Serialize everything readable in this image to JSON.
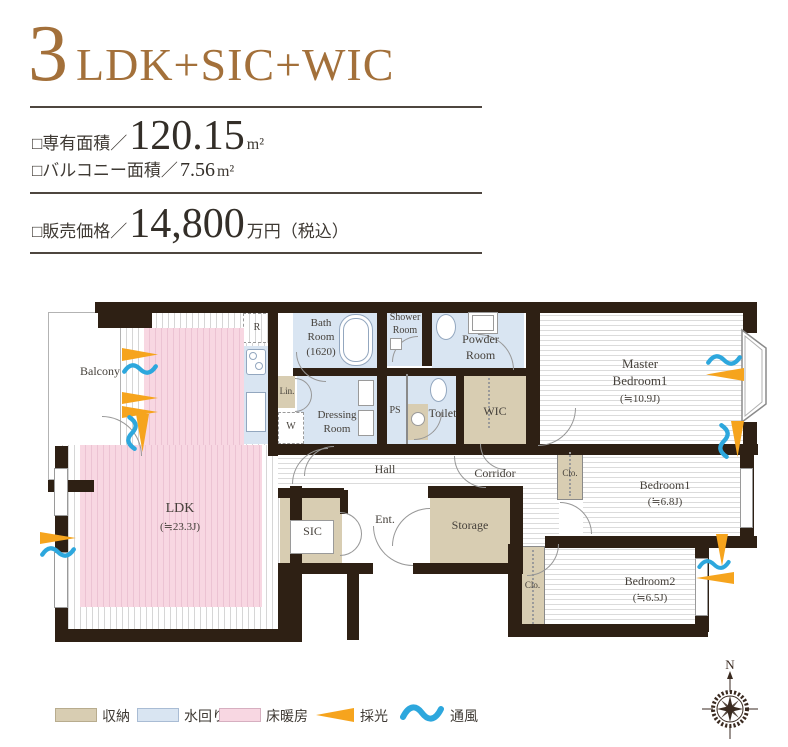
{
  "header": {
    "number": "3",
    "suffix": "LDK+SIC+WIC",
    "specs": [
      {
        "label": "□専有面積／",
        "value": "120.15",
        "unit": "m²"
      },
      {
        "label": "□バルコニー面積／",
        "value": "7.56",
        "unit": "m²"
      }
    ],
    "price": {
      "label": "□販売価格／",
      "value": "14,800",
      "unit": "万円（税込）"
    }
  },
  "rooms": {
    "balcony": "Balcony",
    "ldk": {
      "name": "LDK",
      "size": "(≒23.3J)"
    },
    "bath": {
      "l1": "Bath",
      "l2": "Room",
      "l3": "(1620)"
    },
    "shower": {
      "l1": "Shower",
      "l2": "Room"
    },
    "powder": {
      "l1": "Powder",
      "l2": "Room"
    },
    "dressing": {
      "l1": "Dressing",
      "l2": "Room"
    },
    "master": {
      "l1": "Master",
      "l2": "Bedroom1",
      "size": "(≒10.9J)"
    },
    "bedroom1": {
      "name": "Bedroom1",
      "size": "(≒6.8J)"
    },
    "bedroom2": {
      "name": "Bedroom2",
      "size": "(≒6.5J)"
    },
    "hall": "Hall",
    "corridor": "Corridor",
    "sic": "SIC",
    "ent": "Ent.",
    "storage": "Storage",
    "toilet": "Toilet",
    "wic": "WIC",
    "ps": "PS",
    "lin": "Lin.",
    "w": "W",
    "r": "R",
    "clo": "Clo."
  },
  "legend": {
    "storage": "収納",
    "water": "水回り",
    "heating": "床暖房",
    "daylight": "採光",
    "ventilation": "通風"
  },
  "compass": {
    "label": "N"
  },
  "colors": {
    "accent_brown": "#a3703a",
    "wall": "#2e2014",
    "storage_beige": "#d8cdb2",
    "water_blue": "#d9e5f2",
    "heating_pink": "#f8d7e2",
    "daylight_orange": "#f6a41d",
    "ventilation_blue": "#2da7dd"
  }
}
